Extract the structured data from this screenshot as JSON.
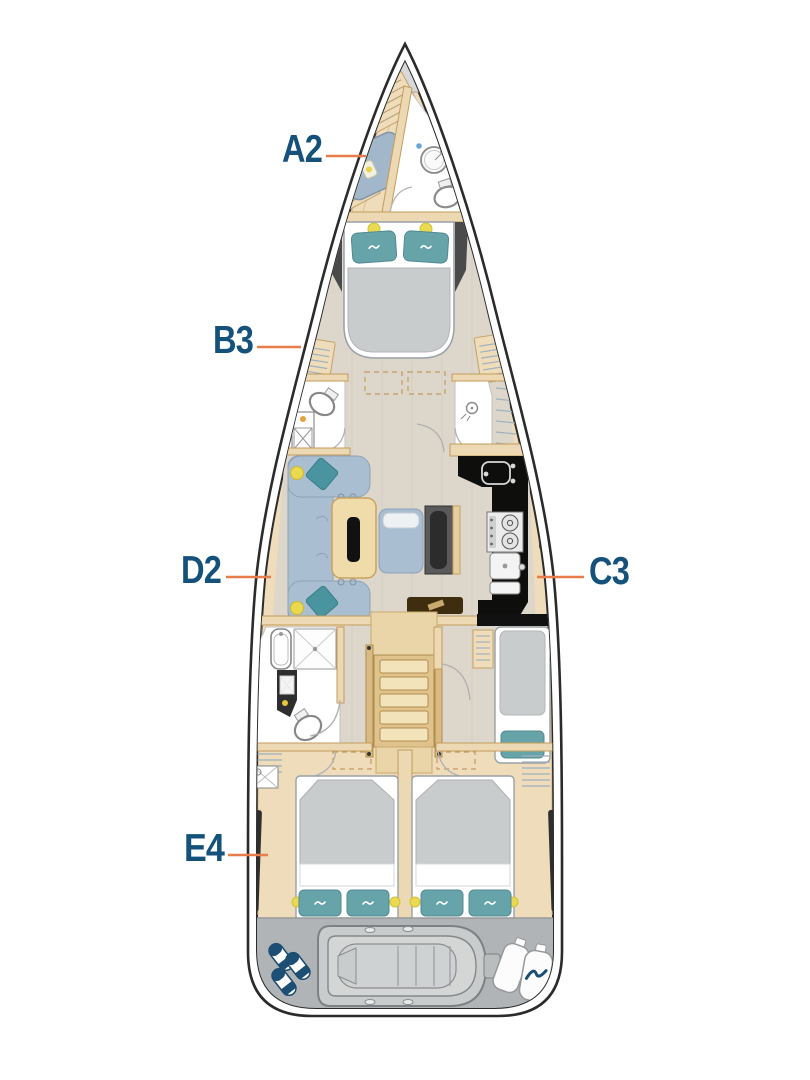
{
  "diagram": {
    "type": "sailing-yacht-interior-deck-plan",
    "cabin_labels": [
      {
        "id": "A2",
        "text": "A2"
      },
      {
        "id": "B3",
        "text": "B3"
      },
      {
        "id": "C3",
        "text": "C3"
      },
      {
        "id": "D2",
        "text": "D2"
      },
      {
        "id": "E4",
        "text": "E4"
      }
    ],
    "colors": {
      "label_text": "#14527b",
      "leader_line": "#e87c4b",
      "hull_line": "#2b2b2b",
      "wood": "#eedcba",
      "floor": "#ddd6cb",
      "upholstery_blue": "#a9bed1",
      "pillow_teal": "#67a4a9",
      "accent_teal": "#49949e",
      "accent_yellow": "#e9da52",
      "mattress_gray": "#c9cccc",
      "galley_black": "#0e0e0c",
      "transom_gray": "#b1b4b6",
      "fender_navy": "#1d4e74"
    }
  }
}
